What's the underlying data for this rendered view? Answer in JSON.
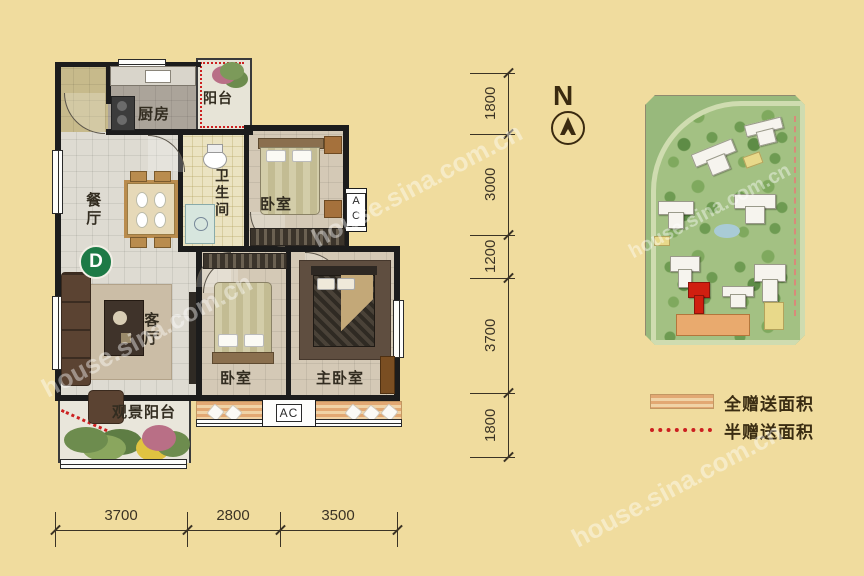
{
  "page": {
    "watermark": "house.sina.com.cn",
    "background": "#f0dc9e"
  },
  "floor_plan": {
    "unit_badge": "D",
    "ac_label": "AC",
    "rooms": [
      {
        "id": "balcony-top",
        "label": "阳台"
      },
      {
        "id": "kitchen",
        "label": "厨房"
      },
      {
        "id": "bathroom",
        "label": "卫生间"
      },
      {
        "id": "bedroom-top",
        "label": "卧室"
      },
      {
        "id": "dining",
        "label": "餐厅"
      },
      {
        "id": "living",
        "label": "客厅"
      },
      {
        "id": "bedroom-middle",
        "label": "卧室"
      },
      {
        "id": "master-bedroom",
        "label": "主卧室"
      },
      {
        "id": "view-balcony",
        "label": "观景阳台"
      }
    ]
  },
  "dimensions": {
    "bottom": [
      "3700",
      "2800",
      "3500"
    ],
    "right": [
      "1800",
      "3000",
      "1200",
      "3700",
      "1800"
    ]
  },
  "compass": {
    "label": "N"
  },
  "legend": {
    "items": [
      {
        "type": "hatch-swatch",
        "label": "全赠送面积"
      },
      {
        "type": "dotted-line",
        "label": "半赠送面积"
      }
    ]
  },
  "colors": {
    "background": "#f0dc9e",
    "wall": "#1c1c1c",
    "badge_green": "#1d7a46",
    "gift_red": "#cc2020",
    "hatch_orange": "#e2a873",
    "map_green": "#a3c183",
    "building_red": "#d01f10"
  }
}
